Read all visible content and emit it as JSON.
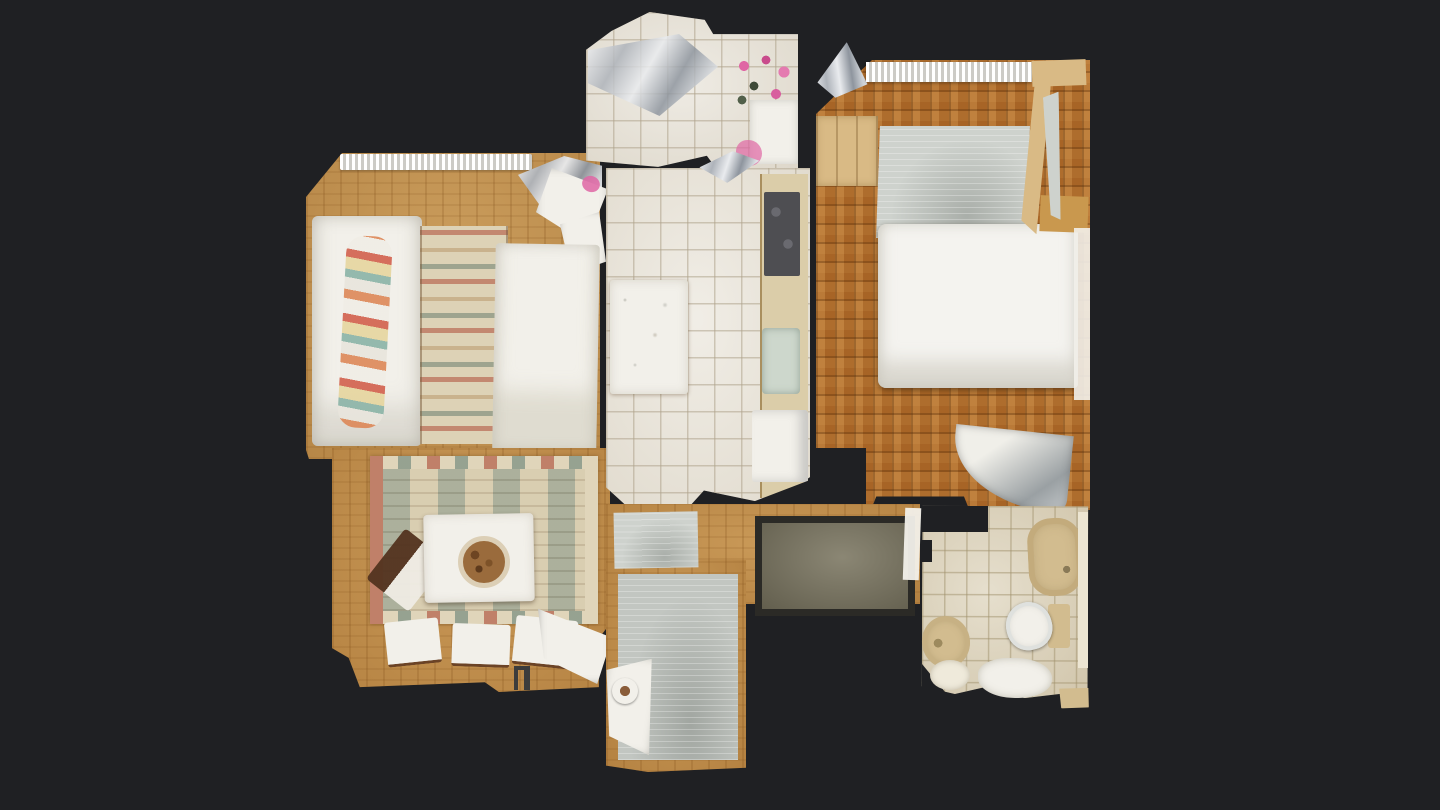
{
  "scene": {
    "type": "3d-scan-top-down-floorplan-view",
    "background": "#1f2023",
    "rooms": [
      {
        "name": "living-room",
        "floor": "wood-plank",
        "objects": [
          "radiator",
          "sofa",
          "throw-blanket",
          "kilim-rug",
          "daybed",
          "window-glass-artifact"
        ]
      },
      {
        "name": "dining-area",
        "floor": "wood-plank",
        "objects": [
          "kilim-rug",
          "dining-table",
          "fruit-bowl",
          "dining-chairs",
          "door-swing",
          "door-handle"
        ]
      },
      {
        "name": "balcony",
        "floor": "white-tile",
        "objects": [
          "chrome-reflection",
          "potted-flowers"
        ]
      },
      {
        "name": "kitchen",
        "floor": "white-tile",
        "objects": [
          "kitchen-table",
          "counter",
          "cooktop",
          "sink",
          "refrigerator",
          "foil-reflection"
        ]
      },
      {
        "name": "bedroom",
        "floor": "parquet-mosaic",
        "objects": [
          "wardrobe",
          "area-rug",
          "double-bed",
          "bedside-shelf",
          "door-swing"
        ]
      },
      {
        "name": "hallway",
        "floor": "wood-parquet",
        "objects": [
          "small-gray-mat",
          "entry-doormat",
          "runner-rug",
          "pet-bowl"
        ]
      },
      {
        "name": "bathroom",
        "floor": "beige-tile",
        "objects": [
          "bathtub",
          "toilet",
          "bidet",
          "towels"
        ]
      }
    ],
    "palette": {
      "bg": "#1f2023",
      "woodLiving": "#c3924f",
      "woodDining": "#c28e4a",
      "woodHall": "#c08c48",
      "parquet": "#ae6d2d",
      "tileKitchen": "#e9e4d9",
      "tileBalcony": "#e6e1d6",
      "tileBath": "#dbd1b8",
      "white": "#f2f0ea",
      "bedWhite": "#f4f3ef",
      "rugCream": "#ddd2b6",
      "rugGray": "#c2c6c1",
      "rugGrayLight": "#ced2cd",
      "matOlive": "#7b7661",
      "matBorder": "#2b2a26",
      "fixtureBeige": "#d2bc8f",
      "counterBeige": "#dbcda9",
      "cooktopGray": "#4e4e52",
      "sinkGreen": "#cdd7cc",
      "wardrobeTan": "#d9ba85",
      "pink": "#df66a4",
      "doorGray": "#9aa0a3",
      "bowlBrown": "#9a6b3c",
      "woodShelf": "#c9984e"
    }
  }
}
